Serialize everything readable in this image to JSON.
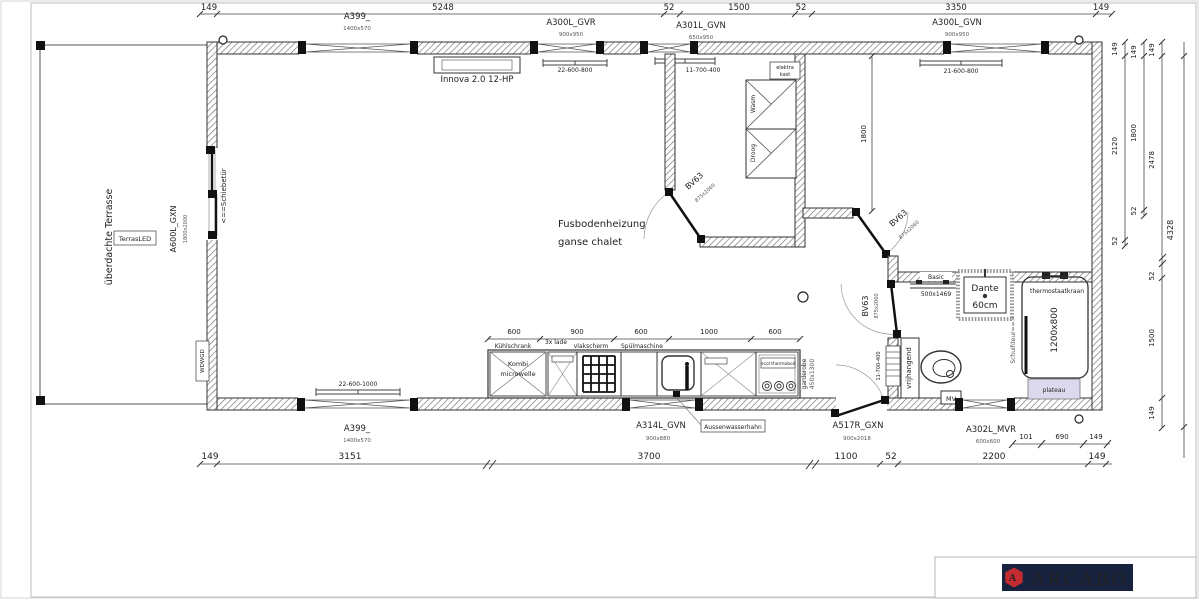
{
  "dims": {
    "top": [
      "149",
      "5248",
      "52",
      "1500",
      "52",
      "3350",
      "149"
    ],
    "bottom": [
      "149",
      "3151",
      "3700",
      "1100",
      "52",
      "2200",
      "149"
    ],
    "bottom_inner": [
      "101",
      "690",
      "149"
    ],
    "right_col1": [
      "149",
      "2120",
      "52"
    ],
    "right_col2": [
      "149",
      "1800",
      "52"
    ],
    "right_col3": [
      "149",
      "2478",
      "52",
      "1500",
      "149"
    ],
    "right_total": "4328",
    "kitchen": [
      "600",
      "900",
      "600",
      "1000",
      "600"
    ],
    "interior_height": "1800"
  },
  "windows": {
    "a399_top": {
      "code": "A399_",
      "size": "1400x570"
    },
    "a300l_gvr": {
      "code": "A300L_GVR",
      "size": "900x950",
      "vent": "22-600-800"
    },
    "a301l_gvn": {
      "code": "A301L_GVN",
      "size": "650x950",
      "vent": "11-700-400"
    },
    "a300l_gvn": {
      "code": "A300L_GVN",
      "size": "900x950",
      "vent": "21-600-800"
    },
    "a399_bottom": {
      "code": "A399_",
      "size": "1400x570",
      "vent": "22-600-1000"
    },
    "a314l_gvn": {
      "code": "A314L_GVN",
      "size": "900x880"
    },
    "a517r_gxn": {
      "code": "A517R_GXN",
      "size": "900x2018"
    },
    "a302l_mvr": {
      "code": "A302L_MVR",
      "size": "600x600"
    },
    "a600l_gxn": {
      "code": "A600L_GXN",
      "size": "1800x2000"
    },
    "bath_vent": "11-700-400"
  },
  "doors": {
    "code": "BV63",
    "size": "875x2060"
  },
  "labels": {
    "innova": "Innova 2.0 12-HP",
    "elektra_line1": "elektra",
    "elektra_line2": "kast",
    "washer": "Wasm",
    "dryer": "Droog",
    "floor_heating_line1": "Fusbodenheizung",
    "floor_heating_line2": "ganse chalet",
    "terrace": "überdachte Terrasse",
    "terras_led": "TerrasLED",
    "sliding_door": "<==Schiebetür",
    "wdwgd": "WDWGD",
    "basin": "Basic",
    "basin_size": "500x1469",
    "shower_line1": "Dante",
    "shower_line2": "60cm",
    "thermostat": "thermostaatkraan",
    "tray_size": "1200x800",
    "shower_door": "Schuifdeur==>",
    "toilet": "vrijhangend",
    "mv": "MV",
    "plateau": "plateau",
    "fridge": "Kühlschrank",
    "fridge_line1": "Kombi",
    "fridge_line2": "microwelle",
    "drawers": "3x lade",
    "panel": "vlakscherm",
    "dishwasher": "Spülmaschine",
    "boiler": "ecol thermoboil",
    "wardrobe": "garderobe",
    "wardrobe_size": "450x1300",
    "outdoor_tap": "Aussenwasserhahn"
  },
  "brand": {
    "name": "ARCABO",
    "logo_letter": "A"
  },
  "colors": {
    "plateau_fill": "#dcd9ee",
    "logo_bg": "#17233e",
    "logo_red": "#c42b30"
  }
}
